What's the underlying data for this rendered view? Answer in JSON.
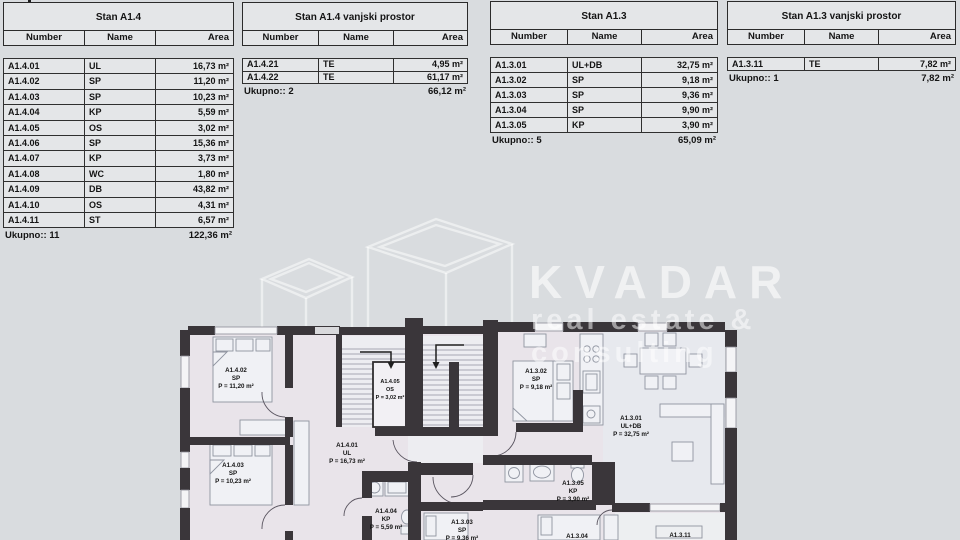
{
  "colors": {
    "background": "#d9dcdf",
    "wall": "#3a363a",
    "watermark": "#ffffff",
    "room_fill": "#e9e4ea"
  },
  "watermark": {
    "brand": "KVADAR",
    "tagline1": "real estate &",
    "tagline2": "consulting"
  },
  "tables": [
    {
      "title": "Stan A1.4",
      "columns": [
        "Number",
        "Name",
        "Area"
      ],
      "rows": [
        {
          "number": "A1.4.01",
          "name": "UL",
          "area": "16,73 m²"
        },
        {
          "number": "A1.4.02",
          "name": "SP",
          "area": "11,20 m²"
        },
        {
          "number": "A1.4.03",
          "name": "SP",
          "area": "10,23 m²"
        },
        {
          "number": "A1.4.04",
          "name": "KP",
          "area": "5,59 m²"
        },
        {
          "number": "A1.4.05",
          "name": "OS",
          "area": "3,02 m²"
        },
        {
          "number": "A1.4.06",
          "name": "SP",
          "area": "15,36 m²"
        },
        {
          "number": "A1.4.07",
          "name": "KP",
          "area": "3,73 m²"
        },
        {
          "number": "A1.4.08",
          "name": "WC",
          "area": "1,80 m²"
        },
        {
          "number": "A1.4.09",
          "name": "DB",
          "area": "43,82 m²"
        },
        {
          "number": "A1.4.10",
          "name": "OS",
          "area": "4,31 m²"
        },
        {
          "number": "A1.4.11",
          "name": "ST",
          "area": "6,57 m²"
        }
      ],
      "total_label": "Ukupno:: 11",
      "total_area": "122,36 m²"
    },
    {
      "title": "Stan A1.4 vanjski prostor",
      "columns": [
        "Number",
        "Name",
        "Area"
      ],
      "rows": [
        {
          "number": "A1.4.21",
          "name": "TE",
          "area": "4,95 m²"
        },
        {
          "number": "A1.4.22",
          "name": "TE",
          "area": "61,17 m²"
        }
      ],
      "total_label": "Ukupno:: 2",
      "total_area": "66,12 m²"
    },
    {
      "title": "Stan A1.3",
      "columns": [
        "Number",
        "Name",
        "Area"
      ],
      "rows": [
        {
          "number": "A1.3.01",
          "name": "UL+DB",
          "area": "32,75 m²"
        },
        {
          "number": "A1.3.02",
          "name": "SP",
          "area": "9,18 m²"
        },
        {
          "number": "A1.3.03",
          "name": "SP",
          "area": "9,36 m²"
        },
        {
          "number": "A1.3.04",
          "name": "SP",
          "area": "9,90 m²"
        },
        {
          "number": "A1.3.05",
          "name": "KP",
          "area": "3,90 m²"
        }
      ],
      "total_label": "Ukupno:: 5",
      "total_area": "65,09 m²"
    },
    {
      "title": "Stan A1.3 vanjski prostor",
      "columns": [
        "Number",
        "Name",
        "Area"
      ],
      "rows": [
        {
          "number": "A1.3.11",
          "name": "TE",
          "area": "7,82 m²"
        }
      ],
      "total_label": "Ukupno:: 1",
      "total_area": "7,82 m²"
    }
  ],
  "floorplan": {
    "rooms": [
      {
        "id": "A1.4.01",
        "type": "UL",
        "area": "P = 16,73 m²"
      },
      {
        "id": "A1.4.02",
        "type": "SP",
        "area": "P = 11,20 m²"
      },
      {
        "id": "A1.4.03",
        "type": "SP",
        "area": "P = 10,23 m²"
      },
      {
        "id": "A1.4.04",
        "type": "KP",
        "area": "P = 5,59 m²"
      },
      {
        "id": "A1.4.05",
        "type": "OS",
        "area": "P = 3,02 m²"
      },
      {
        "id": "A1.3.01",
        "type": "UL+DB",
        "area": "P = 32,75 m²"
      },
      {
        "id": "A1.3.02",
        "type": "SP",
        "area": "P = 9,18 m²"
      },
      {
        "id": "A1.3.03",
        "type": "SP",
        "area": "P = 9,36 m²"
      },
      {
        "id": "A1.3.04",
        "type": "",
        "area": ""
      },
      {
        "id": "A1.3.05",
        "type": "KP",
        "area": "P = 3,90 m²"
      },
      {
        "id": "A1.3.11",
        "type": "",
        "area": ""
      }
    ]
  }
}
